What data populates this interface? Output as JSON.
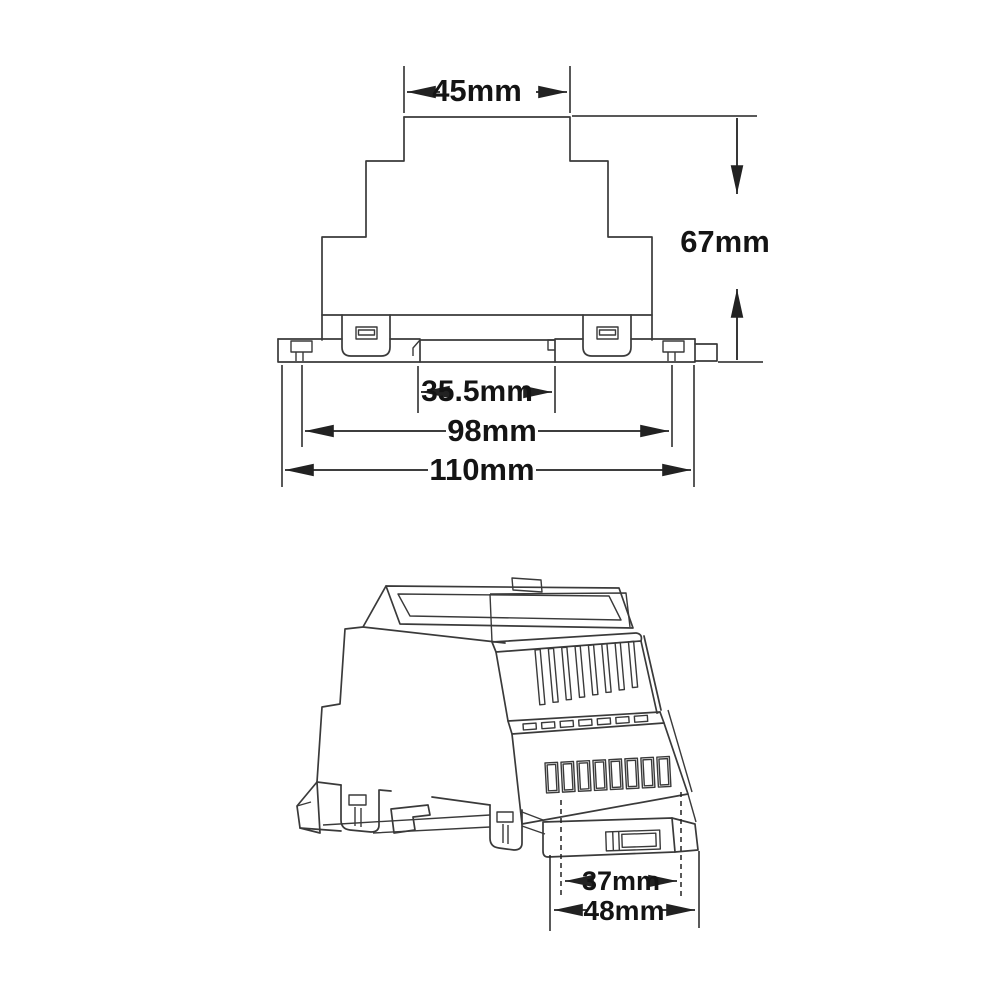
{
  "palette": {
    "background": "#ffffff",
    "line_color": "#3a3a3a",
    "dimension_color": "#222222",
    "text_color": "#141414"
  },
  "front_view": {
    "dims": {
      "top_width": "45mm",
      "height": "67mm",
      "rail_channel_width": "35.5mm",
      "mount_width": "98mm",
      "overall_width": "110mm"
    }
  },
  "iso_view": {
    "dims": {
      "rail_depth": "37mm",
      "overall_depth": "48mm"
    }
  }
}
